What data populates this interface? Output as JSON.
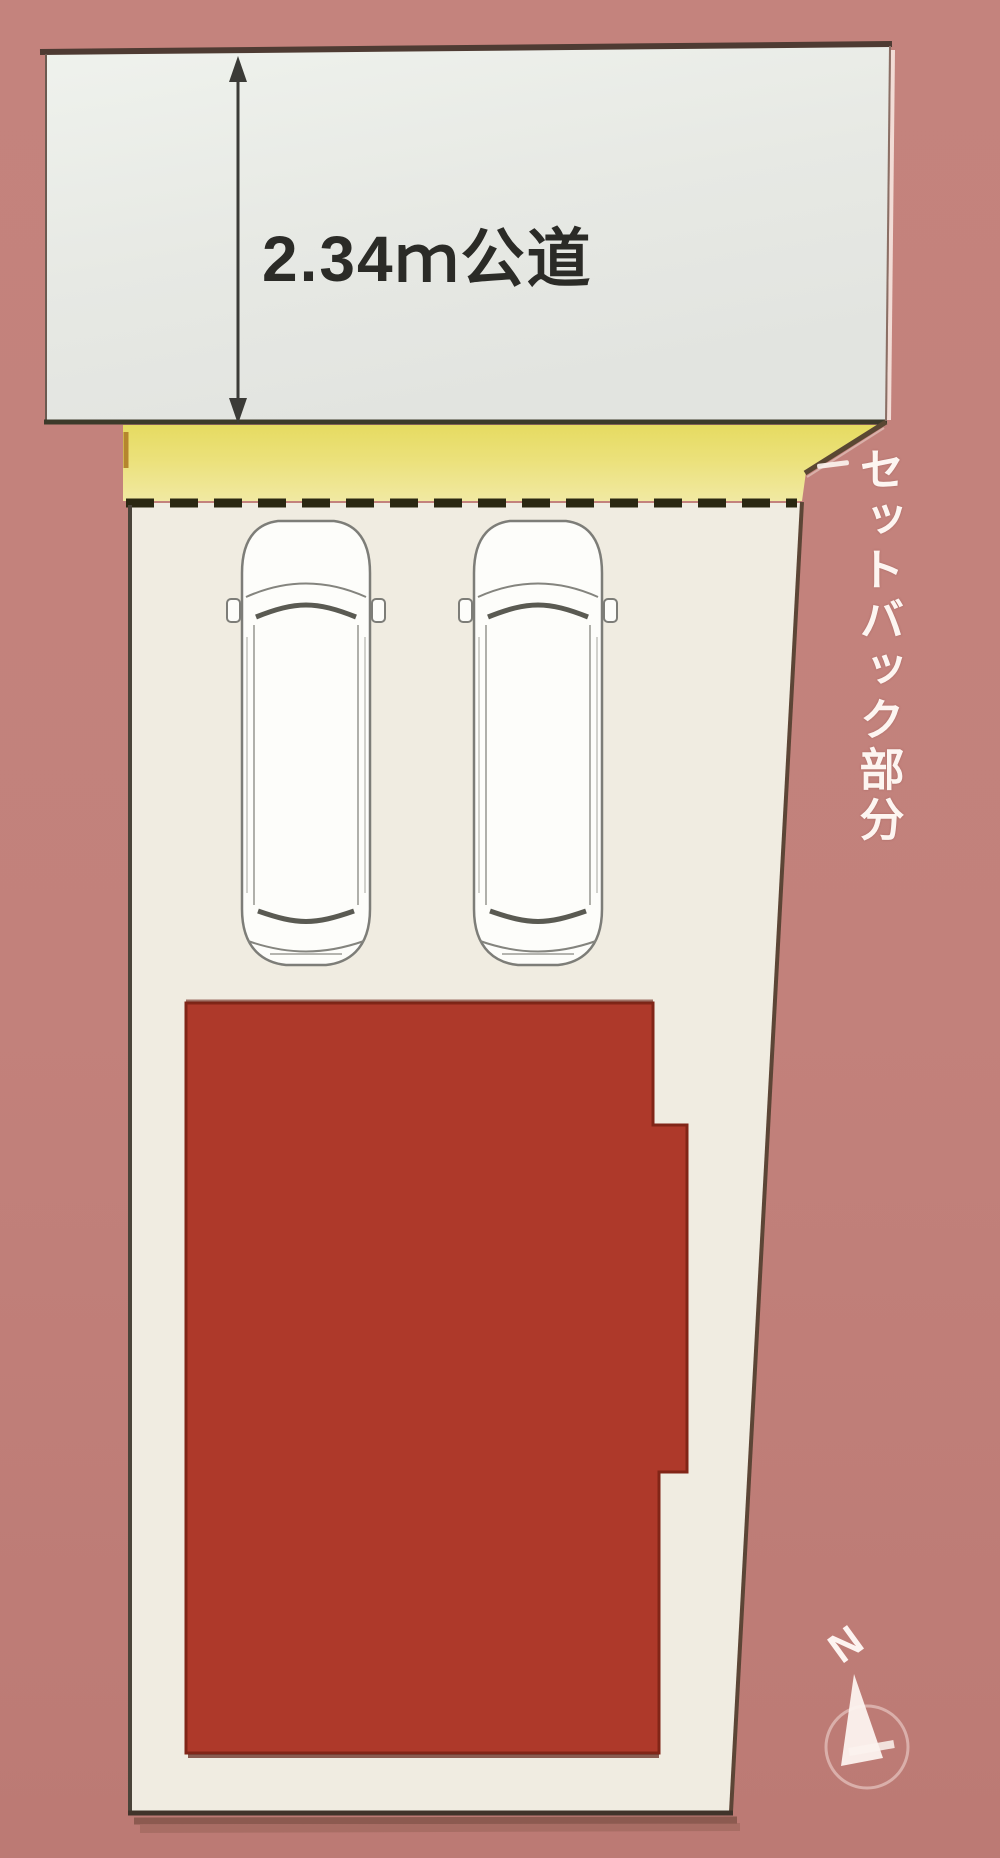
{
  "diagram": {
    "type": "real-estate site plan",
    "road_label": "2.34ｍ公道",
    "setback_label": "セットバック部分",
    "compass_north": "N",
    "car_count": 2
  },
  "colors": {
    "background": "#c2817b",
    "road_fill": "#e7e9e4",
    "setback_fill": "#ebe17a",
    "lot_fill": "#f0ece1",
    "building_fill": "#ae392a",
    "dashed_line": "#2b2812",
    "outline_dark": "#42392e",
    "label_dark": "#2b2b27",
    "label_light": "#fdf5f1"
  }
}
